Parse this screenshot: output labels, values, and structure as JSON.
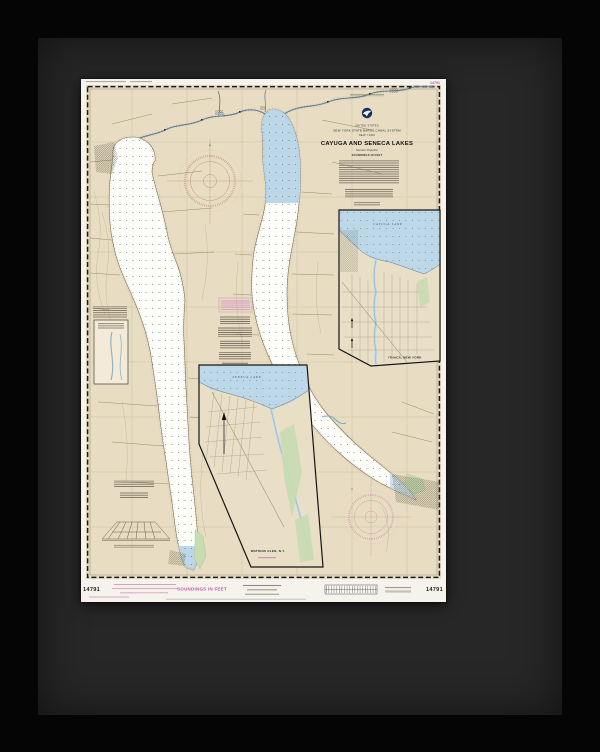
{
  "header": {
    "country": "UNITED STATES",
    "authority": "NEW YORK STATE BARGE CANAL SYSTEM",
    "state": "NEW YORK",
    "title": "CAYUGA AND SENECA LAKES",
    "projection": "Mercator Projection",
    "soundings": "SOUNDINGS IN FEET"
  },
  "margin": {
    "left_number": "14791",
    "right_number": "14791",
    "top_right_number": "14791",
    "soundings": "SOUNDINGS IN FEET"
  },
  "insets": {
    "ithaca": {
      "water": "CAYUGA LAKE",
      "title": "ITHACA, NEW YORK"
    },
    "watkins_glen": {
      "water": "SENECA LAKE",
      "title": "WATKINS GLEN, N.Y."
    }
  },
  "colors": {
    "frame": "#050505",
    "mat": "#272727",
    "paper": "#f6f3ec",
    "chart_background": "#e8ddc3",
    "shallow_water": "#bcd8e8",
    "deep_water": "#fdfdfa",
    "marsh": "#c8dcb2",
    "magenta_ink": "#bf55a4",
    "compass_rose_north": "#b98a74",
    "compass_rose_south": "#c98f9d"
  }
}
